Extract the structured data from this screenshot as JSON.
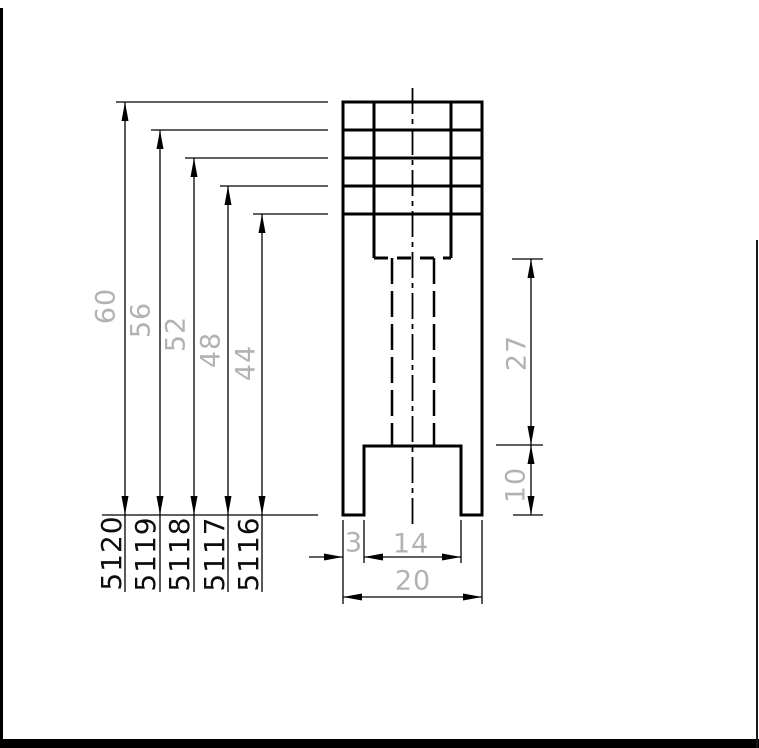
{
  "page": {
    "background": "#ffffff",
    "line_color": "#000000",
    "dim_text_color": "#b2b2b2",
    "item_text_color": "#0d0d0d"
  },
  "height_dims": [
    "60",
    "56",
    "52",
    "48",
    "44"
  ],
  "item_numbers": [
    "5120",
    "5119",
    "5118",
    "5117",
    "5116"
  ],
  "side_dims": [
    "27",
    "10"
  ],
  "bottom_dims": [
    "3",
    "14",
    "20"
  ]
}
